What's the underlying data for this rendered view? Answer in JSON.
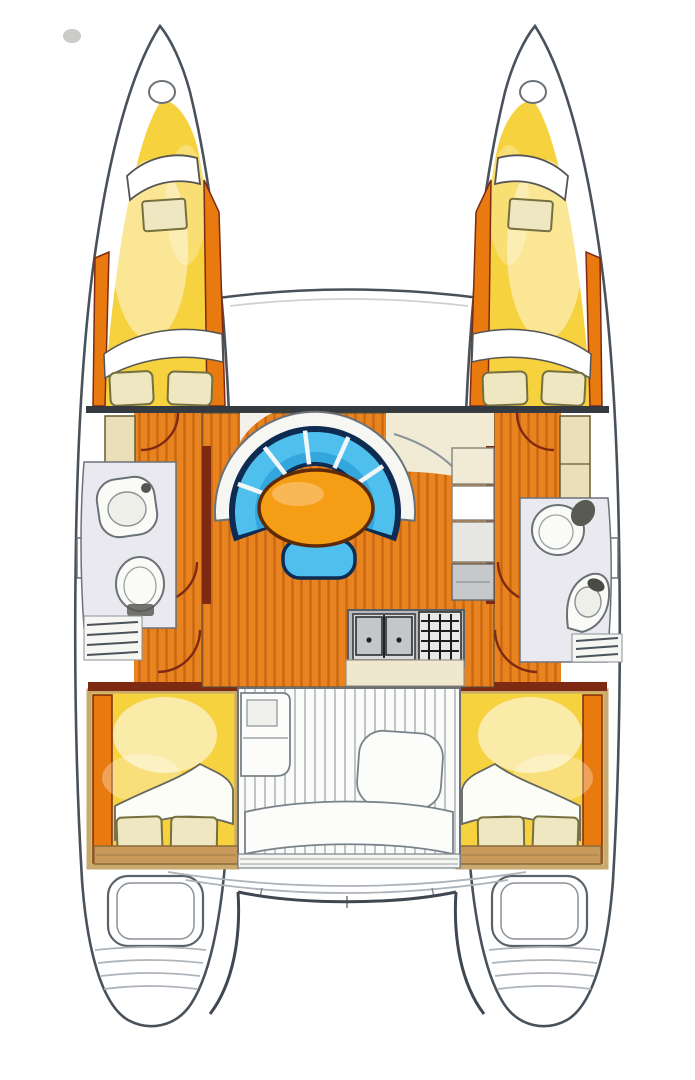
{
  "title": "Catamaran interior layout floor plan",
  "colors": {
    "hullStroke": "#49525B",
    "woodBase": "#E8831F",
    "woodStripe": "#BE5E0D",
    "woodDark": "#7E2A12",
    "trimOrange": "#E87A10",
    "yellow": "#F7D23F",
    "tan": "#C9995B",
    "bedFrame": "#C8A96E",
    "pillow": "#EFE6C2",
    "pillowLine": "#75703E",
    "blue": "#4FC0EE",
    "blueShade": "#1E8FD0",
    "navy": "#0E2C52",
    "tableOrange": "#F59D14",
    "cream": "#F1EBD6",
    "counter": "#EFE8CF",
    "headFloor": "#E9E9EF",
    "fixture": "#6A7278",
    "teakLine": "#ACB3B9",
    "applianceDark": "#232527"
  },
  "areas": {
    "portHull": "port hull",
    "starboardHull": "starboard hull",
    "portBowCabin": "port forward cabin with berth and pillows",
    "starboardBowCabin": "starboard forward cabin with berth and pillows",
    "foredeck": "foredeck between bows",
    "salon": "central salon with wood floor",
    "settee": "curved blue settee",
    "table": "oval salon table",
    "stool": "blue stool seat",
    "galley": "galley with double sink and stove",
    "portHead": "port head with sink, toilet and shower",
    "starboardHead": "starboard head with toilet, sink and shower",
    "portAftCabin": "port aft cabin berth",
    "starboardAftCabin": "starboard aft cabin berth",
    "cockpit": "aft cockpit with teak deck and seats",
    "portTransom": "port transom with engine hatch and steps",
    "starboardTransom": "starboard transom with engine hatch and steps"
  }
}
